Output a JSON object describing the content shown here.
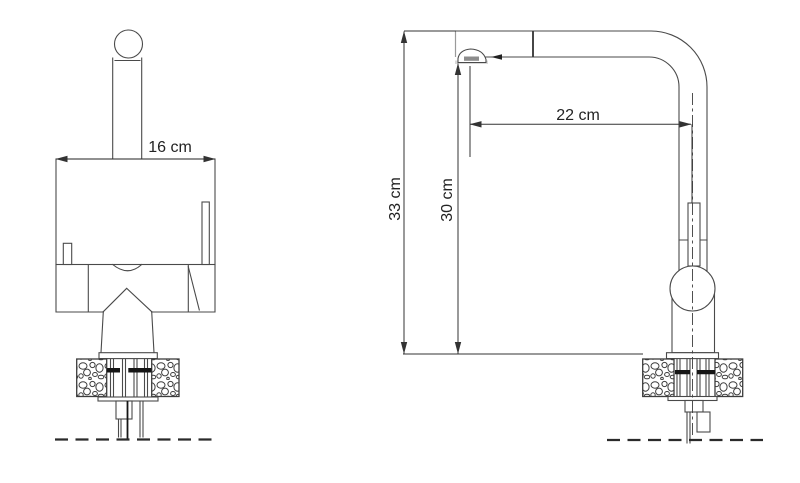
{
  "drawing": {
    "front_view": {
      "width_label": "16 cm"
    },
    "side_view": {
      "spout_reach_label": "22 cm",
      "overall_height_label": "33 cm",
      "spout_height_label": "30 cm"
    },
    "colors": {
      "outline": "#4a4a4a",
      "dimension_line": "#333333",
      "label_text": "#232323",
      "hardware_accent": "#161616",
      "background": "#ffffff"
    }
  }
}
